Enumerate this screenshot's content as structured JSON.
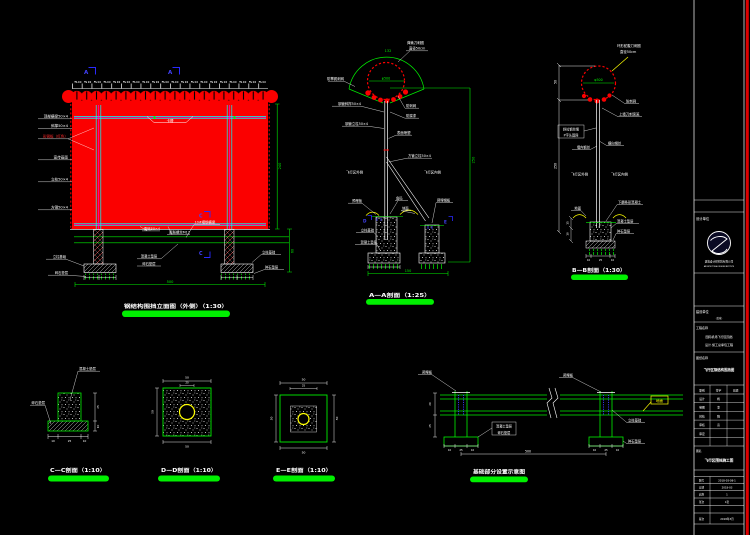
{
  "colors": {
    "background": "#000000",
    "panel_red": "#fb0000",
    "cad_green": "#00ef00",
    "cad_cyan": "#00ffff",
    "cad_magenta": "#ff00ff",
    "cad_blue": "#4343ff",
    "cad_yellow": "#ffff00",
    "border_red": "#dd0000"
  },
  "elevation": {
    "title": "钢结构围挡立面图（外侧）（1:30）",
    "marker_a": "A",
    "marker_c": "C",
    "top_dims": "50 50 50 50 50 50 50 50 50 50 50 50 50 50 50 50 50 50 50 50",
    "slot": "卡槽",
    "left_labels": [
      "顶部横梁50×4",
      "斜撑50×4",
      "彩钢板（红色）",
      "宣传画面",
      "立柱50×4",
      "方钢50×4"
    ],
    "corner": "角码50×4",
    "bolt": "膨胀螺丝M12",
    "beam": "10#槽钢横梁",
    "pad": "混凝土垫层",
    "gravel": "碎石垫层",
    "footing_l": "立柱基础",
    "gravel_l": "碎石垫层",
    "footing_r": "立柱基础",
    "gravel_r": "碎石垫层",
    "dim_total": "500",
    "dim_h": "240",
    "dim_d": "60"
  },
  "aa": {
    "title": "A—A剖面（1:25）",
    "dim_arc": "132",
    "dim_dia": "φ500",
    "dim_h": "250",
    "dim_total": "150",
    "coil1": "弹簧刀刺圈",
    "coil2": "直径50cm",
    "l1": "防攀爬刺网",
    "l2": "钢管斜撑50×4",
    "l3": "钢管立柱50×4",
    "l4": "飞行区外侧",
    "r1": "防刺网",
    "r2": "防腐漆",
    "r3": "表面喷塑",
    "r4": "方管立柱50×4",
    "r5": "飞行区内侧",
    "embed_l": "预埋板",
    "corner": "角码",
    "ground": "地面",
    "embed_r": "预埋钢板",
    "footing": "立柱基础",
    "pad": "混凝土垫层",
    "marker_d": "D",
    "marker_e": "E"
  },
  "bb": {
    "title": "B—B剖面（1:30）",
    "coil1": "环形蛇腹刀刺圈",
    "coil2": "直径50cm",
    "dim_dia": "φ500",
    "dim_top": "50",
    "dim_h": "250",
    "dim_f1": "15",
    "dim_f2": "10",
    "r1": "防刺网",
    "r2": "上墙刀刺滚笼",
    "box1": "斜拉钢丝绳",
    "box2": "P字头固网",
    "wire_l": "墙内钢丝",
    "wire_r": "横向钢丝",
    "outside": "飞行区外侧",
    "inside": "飞行区内侧",
    "ground": "地面",
    "strip": "下翻条形混凝土",
    "pad": "混凝土垫层",
    "gravel": "碎石垫层",
    "b1": "10",
    "b2": "25",
    "b3": "10"
  },
  "cc": {
    "title": "C—C剖面（1:10）",
    "pad": "混凝土垫层",
    "gravel": "碎石垫层",
    "b1": "10",
    "b2": "25",
    "b3": "10",
    "r1": "25",
    "r2": "10"
  },
  "dd": {
    "title": "D—D剖面（1:10）",
    "top": "50",
    "inner": "20",
    "left": "50",
    "bottom": "50"
  },
  "ee": {
    "title": "E—E剖面（1:10）",
    "top": "50",
    "inner": "25",
    "left": "50",
    "right": "50",
    "bottom": "50"
  },
  "plan": {
    "title": "基础部分设置示意图",
    "embed_l": "预埋板",
    "embed_r": "预埋板",
    "ground": "地面",
    "pad": "混凝土垫层",
    "gravel": "碎石垫层",
    "footing": "立柱基础",
    "gravel2": "碎石垫层",
    "dim_v1": "20",
    "dim_v2": "25",
    "dim_total": "500",
    "f1": "10",
    "f2": "25",
    "f3": "10"
  },
  "titleblock": {
    "design_label": "设计单位",
    "company": "建筑设计研究院有限公司",
    "company_en": "ARCHITECTURAL DESIGN INSTITUTE",
    "client_label": "建设单位",
    "client_sub": "（盖章）",
    "project_label": "工程名称",
    "project1": "国际机场飞行区围挡",
    "project2": "设计·施工总承包工程",
    "drawing_label": "图纸名称",
    "drawing_name": "飞行区钢结构围挡图",
    "th1": "职别",
    "th2": "签字",
    "th3": "日期",
    "rows": [
      {
        "k": "设计",
        "v": "杨"
      },
      {
        "k": "制图",
        "v": "李"
      },
      {
        "k": "校核",
        "v": "程"
      },
      {
        "k": "审核",
        "v": "高"
      },
      {
        "k": "审定",
        "v": ""
      }
    ],
    "name_label": "图名",
    "name_text": "飞行区围挡施工图",
    "meta": [
      {
        "k": "图号",
        "v": "2018-03-08-1"
      },
      {
        "k": "日期",
        "v": "2018-03"
      },
      {
        "k": "比例",
        "v": "1"
      },
      {
        "k": "张次",
        "v": "1张"
      },
      {
        "k": "",
        "v": ""
      },
      {
        "k": "版次",
        "v": "2018年3月"
      }
    ]
  }
}
